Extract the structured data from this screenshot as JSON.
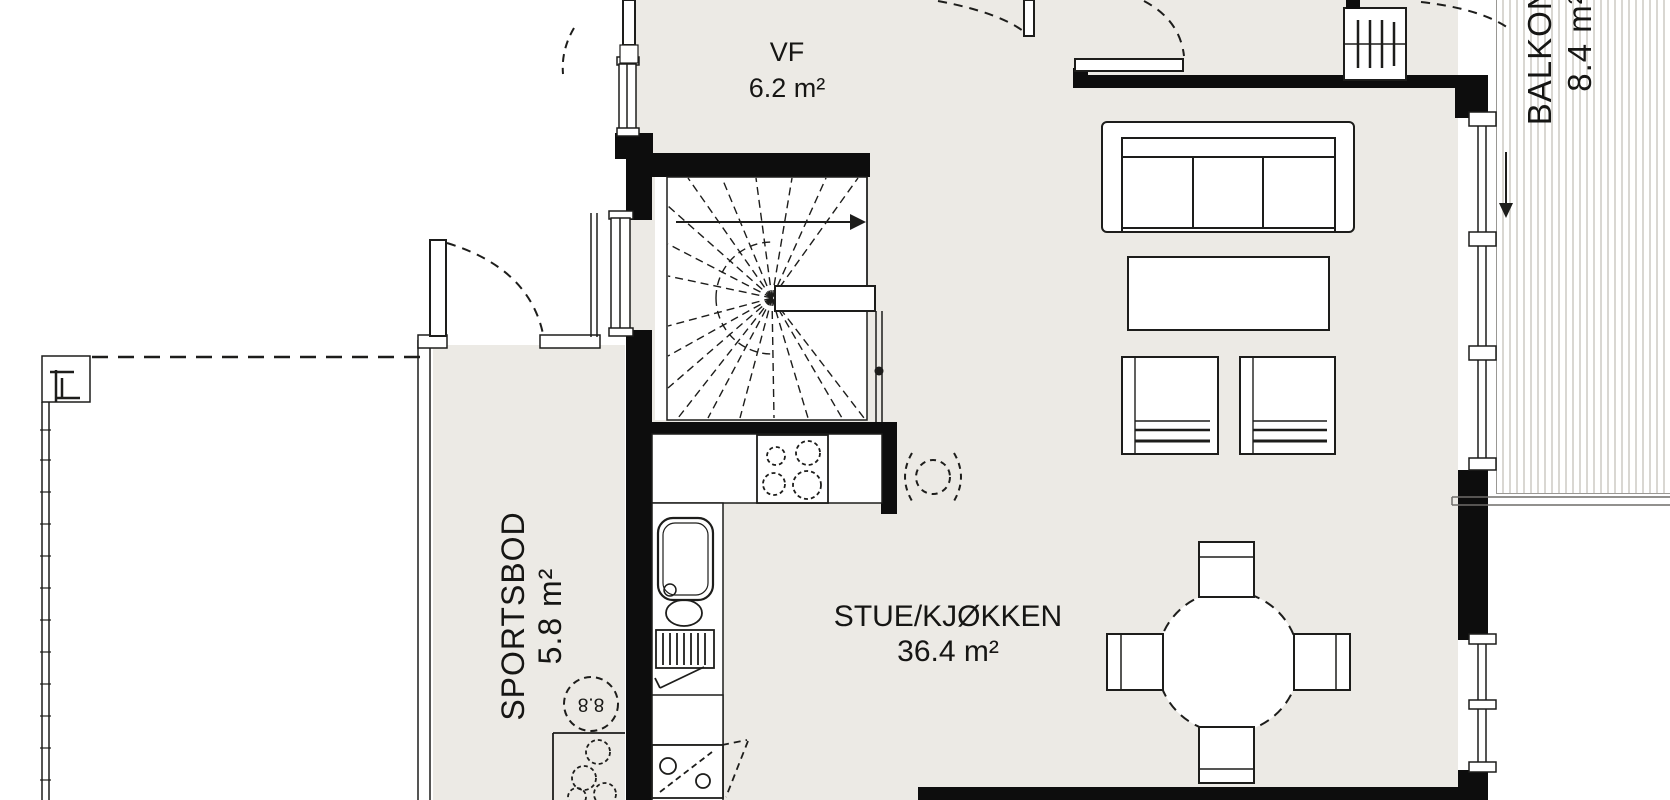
{
  "plan_title": "Floor plan",
  "rooms": [
    {
      "name": "VF",
      "area": "6.2 m²"
    },
    {
      "name": "SPORTSBOD",
      "area": "5.8 m²"
    },
    {
      "name": "STUE/KJØKKEN",
      "area": "36.4 m²"
    },
    {
      "name": "BALKONG",
      "area": "8.4 m²"
    }
  ],
  "annotations": {
    "water_heater_label": "8.8"
  },
  "colors": {
    "background": "#ffffff",
    "floor": "#eceae5",
    "wall": "#0d0d0d",
    "line": "#1d1d1b",
    "deck_stripe": "#d9d7d2"
  }
}
